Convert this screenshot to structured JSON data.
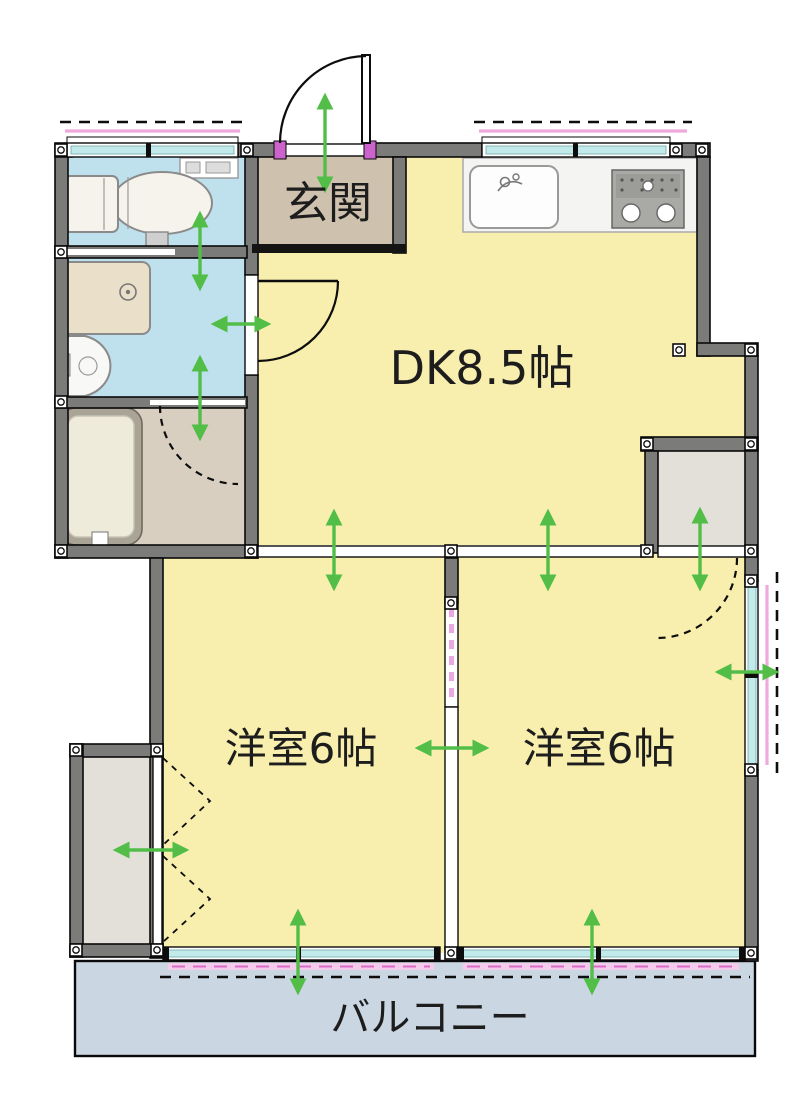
{
  "floor_plan": {
    "type": "japanese-apartment-2dk",
    "rooms": [
      {
        "id": "genkan",
        "label": "玄関"
      },
      {
        "id": "dining-kitchen",
        "label": "DK8.5帖"
      },
      {
        "id": "western-room-left",
        "label": "洋室6帖"
      },
      {
        "id": "western-room-right",
        "label": "洋室6帖"
      },
      {
        "id": "balcony",
        "label": "バルコニー"
      }
    ],
    "colors": {
      "wall": "#7b7b79",
      "room-yellow": "#f8efae",
      "wet-blue": "#bfe1ed",
      "genkan-tan": "#cec2ae",
      "bath-tan": "#d8cfc1",
      "closet-gray": "#e3dfd9",
      "balcony-blue": "#cbd6e3",
      "window-cyan": "#c2eaea",
      "accent-pink": "#efa9dd",
      "accent-magenta": "#cc63cc",
      "arrow-green": "#52be48",
      "text": "#1d1d1d"
    }
  }
}
